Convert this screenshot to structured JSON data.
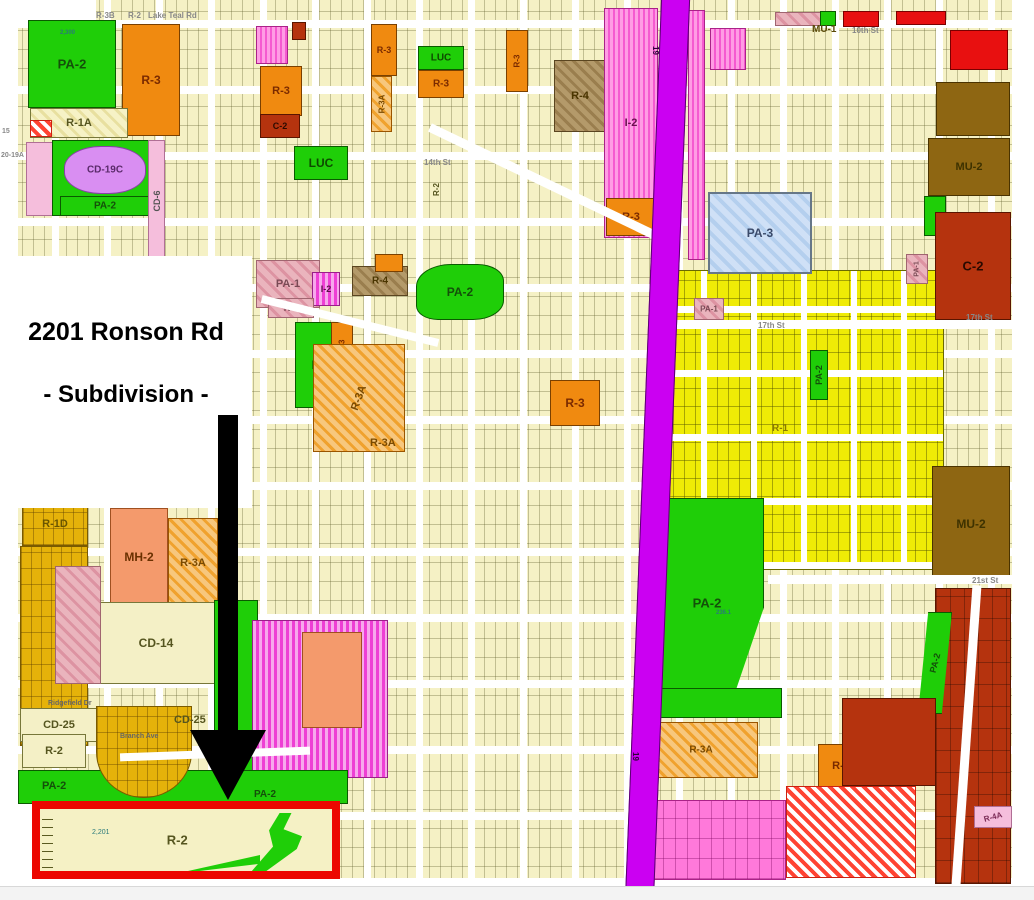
{
  "annotation": {
    "title": "2201 Ronson Rd",
    "subtitle": "- Subdivision -"
  },
  "target": {
    "zone_label": "R-2",
    "parcel_number": "2,201",
    "highlight_color": "#ec0700"
  },
  "map": {
    "colors": {
      "highway": "#cb00f2",
      "arrow": "#000000",
      "pa2_green": "#1fce08",
      "r3_orange": "#f08a10",
      "c2_darkred": "#b5330e",
      "mu2_brown": "#8e6612",
      "pa3_blue": "#cfe0f6",
      "parcel_cream": "#f5f1c5",
      "parcel_yellow": "#efeb06",
      "parcel_gold": "#e5b20a"
    },
    "zones": [
      {
        "x": 0,
        "y": 0,
        "w": 18,
        "h": 800,
        "f": "white"
      },
      {
        "x": 0,
        "y": 0,
        "w": 96,
        "h": 22,
        "f": "white"
      },
      {
        "x": 0,
        "y": 798,
        "w": 32,
        "h": 88,
        "f": "white"
      },
      {
        "x": 650,
        "y": 270,
        "w": 294,
        "h": 300,
        "f": "yellowParcels"
      },
      {
        "x": 20,
        "y": 546,
        "w": 68,
        "h": 200,
        "f": "goldParcels"
      },
      {
        "l": "R-1D",
        "x": 22,
        "y": 502,
        "w": 66,
        "h": 44,
        "f": "goldParcels",
        "ls": 11,
        "lc": "#6a5500"
      },
      {
        "x": 935,
        "y": 588,
        "w": 76,
        "h": 296,
        "f": "darkredParcels"
      },
      {
        "x": 638,
        "y": 800,
        "w": 148,
        "h": 80,
        "f": "pinkParcels"
      },
      {
        "l": "PA-2",
        "x": 28,
        "y": 20,
        "w": 88,
        "h": 88,
        "f": "green",
        "ls": 13,
        "lc": "#14500a"
      },
      {
        "l": "R-3",
        "x": 122,
        "y": 24,
        "w": 58,
        "h": 112,
        "f": "orange",
        "ls": 12,
        "lc": "#7a2a00"
      },
      {
        "l": "R-1A",
        "x": 30,
        "y": 108,
        "w": 98,
        "h": 30,
        "f": "creamHatch",
        "ls": 11,
        "lc": "#55551f"
      },
      {
        "x": 30,
        "y": 120,
        "w": 22,
        "h": 17,
        "f": "redHatch"
      },
      {
        "x": 26,
        "y": 142,
        "w": 28,
        "h": 74,
        "f": "pinkLight"
      },
      {
        "x": 52,
        "y": 140,
        "w": 98,
        "h": 76,
        "f": "green"
      },
      {
        "l": "CD-19C",
        "x": 64,
        "y": 146,
        "w": 82,
        "h": 48,
        "f": "purple",
        "ls": 10,
        "lc": "#5a2a6a",
        "r": "45%"
      },
      {
        "l": "PA-2",
        "x": 60,
        "y": 196,
        "w": 90,
        "h": 20,
        "f": "green",
        "ls": 10,
        "lc": "#14500a"
      },
      {
        "l": "CD-6",
        "x": 148,
        "y": 140,
        "w": 17,
        "h": 122,
        "f": "pinkLight",
        "ls": 9,
        "lr": -90,
        "lc": "#555555"
      },
      {
        "l": "R-3",
        "x": 260,
        "y": 66,
        "w": 42,
        "h": 50,
        "f": "orange",
        "ls": 11,
        "lc": "#7a2a00"
      },
      {
        "l": "C-2",
        "x": 260,
        "y": 114,
        "w": 40,
        "h": 24,
        "f": "darkred",
        "ls": 9,
        "lc": "#2a0a00"
      },
      {
        "x": 256,
        "y": 26,
        "w": 32,
        "h": 38,
        "f": "pinkStripe"
      },
      {
        "x": 292,
        "y": 22,
        "w": 14,
        "h": 18,
        "f": "darkred"
      },
      {
        "l": "LUC",
        "x": 294,
        "y": 146,
        "w": 54,
        "h": 34,
        "f": "green",
        "ls": 12,
        "lc": "#0e4a00"
      },
      {
        "l": "R-3",
        "x": 371,
        "y": 24,
        "w": 26,
        "h": 52,
        "f": "orange",
        "ls": 9,
        "lc": "#7a2a00"
      },
      {
        "l": "R-3A",
        "x": 371,
        "y": 76,
        "w": 21,
        "h": 56,
        "f": "orangeHatch",
        "ls": 8,
        "lr": -90,
        "lc": "#7a4a00"
      },
      {
        "l": "LUC",
        "x": 418,
        "y": 46,
        "w": 46,
        "h": 24,
        "f": "green",
        "ls": 10,
        "lc": "#0e4a00"
      },
      {
        "l": "R-3",
        "x": 418,
        "y": 70,
        "w": 46,
        "h": 28,
        "f": "orange",
        "ls": 10,
        "lc": "#7a2a00"
      },
      {
        "l": "R-3",
        "x": 506,
        "y": 30,
        "w": 22,
        "h": 62,
        "f": "orange",
        "ls": 8,
        "lr": -90,
        "lc": "#7a2a00"
      },
      {
        "l": "R-4",
        "x": 554,
        "y": 60,
        "w": 52,
        "h": 72,
        "f": "brownHatch",
        "ls": 11,
        "lc": "#4a3500"
      },
      {
        "l": "I-2",
        "x": 604,
        "y": 8,
        "w": 54,
        "h": 230,
        "f": "pinkStripe",
        "ls": 11,
        "lc": "#6a1050"
      },
      {
        "l": "R-3",
        "x": 606,
        "y": 198,
        "w": 50,
        "h": 38,
        "f": "orange",
        "ls": 11,
        "lc": "#7a2a00"
      },
      {
        "x": 775,
        "y": 12,
        "w": 56,
        "h": 14,
        "f": "pinkHatch"
      },
      {
        "x": 820,
        "y": 11,
        "w": 16,
        "h": 15,
        "f": "green"
      },
      {
        "x": 843,
        "y": 11,
        "w": 36,
        "h": 16,
        "f": "red"
      },
      {
        "x": 896,
        "y": 11,
        "w": 50,
        "h": 14,
        "f": "red"
      },
      {
        "x": 950,
        "y": 30,
        "w": 58,
        "h": 40,
        "f": "red"
      },
      {
        "x": 936,
        "y": 82,
        "w": 74,
        "h": 54,
        "f": "brown"
      },
      {
        "l": "MU-2",
        "x": 928,
        "y": 138,
        "w": 82,
        "h": 58,
        "f": "brown",
        "ls": 11,
        "lc": "#3e3200"
      },
      {
        "x": 688,
        "y": 10,
        "w": 17,
        "h": 250,
        "f": "pinkStripe"
      },
      {
        "x": 710,
        "y": 28,
        "w": 36,
        "h": 42,
        "f": "pinkStripe"
      },
      {
        "x": 924,
        "y": 196,
        "w": 22,
        "h": 40,
        "f": "green"
      },
      {
        "l": "C-2",
        "x": 935,
        "y": 212,
        "w": 76,
        "h": 108,
        "f": "darkred",
        "ls": 13,
        "lc": "#2a0a00"
      },
      {
        "l": "PA-3",
        "x": 708,
        "y": 192,
        "w": 104,
        "h": 82,
        "f": "blueHatch",
        "ls": 12,
        "lc": "#3a4a6a"
      },
      {
        "l": "PA-1",
        "x": 256,
        "y": 260,
        "w": 64,
        "h": 48,
        "f": "pinkHatch",
        "ls": 11,
        "lc": "#7a4a55"
      },
      {
        "l": "I-2",
        "x": 312,
        "y": 272,
        "w": 28,
        "h": 34,
        "f": "magentaStripe",
        "ls": 9,
        "lc": "#5a1048"
      },
      {
        "l": "R-4",
        "x": 352,
        "y": 266,
        "w": 56,
        "h": 30,
        "f": "brownHatch",
        "ls": 10,
        "lc": "#4a3500"
      },
      {
        "l": "R-4",
        "x": 268,
        "y": 298,
        "w": 46,
        "h": 20,
        "f": "pinkHatch",
        "ls": 9,
        "lc": "#7a4a55"
      },
      {
        "x": 375,
        "y": 254,
        "w": 28,
        "h": 18,
        "f": "orange"
      },
      {
        "l": "PA-2",
        "x": 416,
        "y": 264,
        "w": 88,
        "h": 56,
        "f": "green",
        "ls": 12,
        "lc": "#14500a",
        "r": "40% 30% 35% 25%"
      },
      {
        "l": "LUC",
        "x": 295,
        "y": 322,
        "w": 58,
        "h": 86,
        "f": "green",
        "ls": 12,
        "lc": "#0e4a00"
      },
      {
        "l": "R-3",
        "x": 331,
        "y": 322,
        "w": 22,
        "h": 48,
        "f": "orange",
        "ls": 8,
        "lr": -90,
        "lc": "#7a2a00"
      },
      {
        "l": "R-3A",
        "x": 313,
        "y": 344,
        "w": 92,
        "h": 108,
        "f": "orangeHatch",
        "ls": 11,
        "lr": -70,
        "lc": "#7a4a00"
      },
      {
        "l": "R-3",
        "x": 550,
        "y": 380,
        "w": 50,
        "h": 46,
        "f": "orange",
        "ls": 12,
        "lc": "#7a2a00"
      },
      {
        "l": "PA-1",
        "x": 694,
        "y": 298,
        "w": 30,
        "h": 22,
        "f": "pinkHatch",
        "ls": 8,
        "lc": "#7a4a55"
      },
      {
        "l": "PA-1",
        "x": 906,
        "y": 254,
        "w": 22,
        "h": 30,
        "f": "pinkHatch",
        "ls": 7,
        "lr": -90,
        "lc": "#7a4a55"
      },
      {
        "l": "PA-2",
        "x": 810,
        "y": 350,
        "w": 18,
        "h": 50,
        "f": "green",
        "ls": 9,
        "lr": -90,
        "lc": "#14500a"
      },
      {
        "l": "MU-2",
        "x": 932,
        "y": 466,
        "w": 78,
        "h": 116,
        "f": "brown",
        "ls": 12,
        "lc": "#3e3200"
      },
      {
        "l": "PA-2",
        "x": 650,
        "y": 498,
        "w": 114,
        "h": 210,
        "f": "green",
        "ls": 13,
        "lc": "#14500a",
        "c": "polygon(0 0,100% 0,100% 52%,70% 100%,0 100%)"
      },
      {
        "x": 650,
        "y": 688,
        "w": 132,
        "h": 30,
        "f": "green"
      },
      {
        "l": "R-3A",
        "x": 644,
        "y": 722,
        "w": 114,
        "h": 56,
        "f": "orangeHatch",
        "ls": 10,
        "lc": "#7a4a00"
      },
      {
        "l": "R-3",
        "x": 818,
        "y": 744,
        "w": 46,
        "h": 44,
        "f": "orange",
        "ls": 11,
        "lc": "#7a2a00"
      },
      {
        "l": "PA-2",
        "x": 918,
        "y": 612,
        "w": 34,
        "h": 102,
        "f": "green",
        "ls": 9,
        "lr": -75,
        "lc": "#14500a",
        "c": "polygon(30% 0,100% 0,70% 100%,0 100%)"
      },
      {
        "x": 842,
        "y": 698,
        "w": 94,
        "h": 88,
        "f": "darkred"
      },
      {
        "x": 786,
        "y": 786,
        "w": 130,
        "h": 92,
        "f": "redHatch"
      },
      {
        "l": "R-4A",
        "x": 974,
        "y": 806,
        "w": 38,
        "h": 22,
        "f": "pinkLight",
        "ls": 8,
        "lr": -15,
        "lc": "#7a2a55"
      },
      {
        "l": "MH-2",
        "x": 110,
        "y": 508,
        "w": 58,
        "h": 98,
        "f": "salmon",
        "ls": 12,
        "lc": "#6a3000"
      },
      {
        "l": "R-3A",
        "x": 168,
        "y": 518,
        "w": 50,
        "h": 90,
        "f": "orangeHatch",
        "ls": 11,
        "lc": "#7a4a00"
      },
      {
        "l": "CD-14",
        "x": 92,
        "y": 602,
        "w": 128,
        "h": 82,
        "f": "creamPlain",
        "ls": 12,
        "lc": "#55551f"
      },
      {
        "x": 214,
        "y": 600,
        "w": 44,
        "h": 172,
        "f": "green"
      },
      {
        "x": 55,
        "y": 566,
        "w": 46,
        "h": 118,
        "f": "pinkHatch"
      },
      {
        "l": "CD-25",
        "x": 20,
        "y": 708,
        "w": 78,
        "h": 34,
        "f": "creamPlain",
        "ls": 11,
        "lc": "#55551f"
      },
      {
        "l": "R-2",
        "x": 22,
        "y": 734,
        "w": 64,
        "h": 34,
        "f": "creamPlain",
        "ls": 11,
        "lc": "#55551f"
      },
      {
        "x": 252,
        "y": 620,
        "w": 136,
        "h": 158,
        "f": "magentaStripe"
      },
      {
        "x": 302,
        "y": 632,
        "w": 60,
        "h": 96,
        "f": "salmon"
      },
      {
        "x": 18,
        "y": 770,
        "w": 330,
        "h": 34,
        "f": "green"
      },
      {
        "x": 96,
        "y": 706,
        "w": 96,
        "h": 92,
        "f": "goldParcels",
        "r": "0 0 50% 50%"
      }
    ],
    "streets": [
      {
        "x": 652,
        "y": 320,
        "w": 360,
        "h": 9,
        "rot": 0
      },
      {
        "x": 768,
        "y": 575,
        "w": 244,
        "h": 9,
        "rot": 0
      },
      {
        "x": 962,
        "y": 585,
        "w": 9,
        "h": 300,
        "rot": 4
      },
      {
        "x": 417,
        "y": 180,
        "w": 264,
        "h": 9,
        "rot": 25.6
      },
      {
        "x": 259,
        "y": 317,
        "w": 182,
        "h": 8,
        "rot": 14
      },
      {
        "x": 120,
        "y": 750,
        "w": 190,
        "h": 8,
        "rot": -2
      }
    ],
    "labels": [
      {
        "t": "R-3B",
        "x": 96,
        "y": 11,
        "s": 8,
        "c": "#888888"
      },
      {
        "t": "R-2",
        "x": 128,
        "y": 11,
        "s": 8,
        "c": "#888888"
      },
      {
        "t": "Lake Teal Rd",
        "x": 148,
        "y": 11,
        "s": 8,
        "c": "#888888"
      },
      {
        "t": "MU-1",
        "x": 812,
        "y": 24,
        "s": 10,
        "c": "#5b4a08"
      },
      {
        "t": "10th St",
        "x": 852,
        "y": 26,
        "s": 8,
        "c": "#888888"
      },
      {
        "t": "14th St",
        "x": 424,
        "y": 158,
        "s": 8,
        "c": "#888888"
      },
      {
        "t": "17th St",
        "x": 758,
        "y": 321,
        "s": 8,
        "c": "#888888"
      },
      {
        "t": "17th  St",
        "x": 966,
        "y": 313,
        "s": 8,
        "c": "#888888"
      },
      {
        "t": "21st St",
        "x": 972,
        "y": 576,
        "s": 8,
        "c": "#888888"
      },
      {
        "t": "R-1",
        "x": 772,
        "y": 423,
        "s": 10,
        "c": "#8a7a00"
      },
      {
        "t": "R-3A",
        "x": 370,
        "y": 437,
        "s": 11,
        "c": "#7a4a00"
      },
      {
        "t": "CD-25",
        "x": 174,
        "y": 714,
        "s": 11,
        "c": "#55551f"
      },
      {
        "t": "PA-2",
        "x": 42,
        "y": 780,
        "s": 11,
        "c": "#14500a"
      },
      {
        "t": "PA-2",
        "x": 254,
        "y": 789,
        "s": 10,
        "c": "#14500a"
      },
      {
        "t": "R-2",
        "x": 432,
        "y": 196,
        "s": 8,
        "c": "#55551f",
        "r": -90
      },
      {
        "t": "20-19A",
        "x": 1,
        "y": 152,
        "s": 7,
        "c": "#888888"
      },
      {
        "t": "15",
        "x": 2,
        "y": 128,
        "s": 7,
        "c": "#888888"
      },
      {
        "t": "Branch Ave",
        "x": 120,
        "y": 733,
        "s": 7,
        "c": "#666666"
      },
      {
        "t": "Ridgefield Dr",
        "x": 48,
        "y": 700,
        "s": 7,
        "c": "#666666"
      },
      {
        "t": "2,300",
        "x": 60,
        "y": 30,
        "s": 6,
        "c": "#2a7a7a"
      },
      {
        "t": "236.1",
        "x": 716,
        "y": 610,
        "s": 6,
        "c": "#2a7a7a"
      },
      {
        "t": "19",
        "x": 660,
        "y": 46,
        "s": 8,
        "c": "#2a0038",
        "r": 90
      },
      {
        "t": "19",
        "x": 640,
        "y": 752,
        "s": 8,
        "c": "#2a0038",
        "r": 90
      }
    ]
  }
}
